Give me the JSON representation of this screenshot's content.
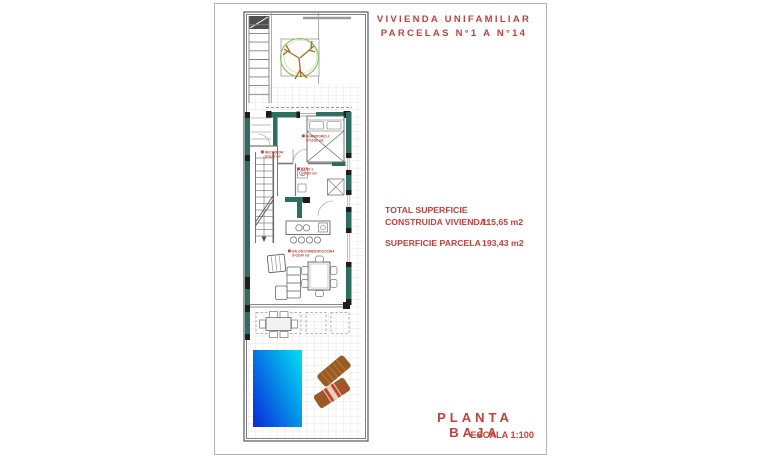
{
  "header": {
    "title_line1": "VIVIENDA UNIFAMILIAR",
    "title_line2": "PARCELAS N°1 A N°14"
  },
  "summary": {
    "total_label_line1": "TOTAL SUPERFICIE",
    "total_label_line2": "CONSTRUIDA VIVIENDA:",
    "total_value": "115,65 m2",
    "parcel_label": "SUPERFICIE PARCELA :",
    "parcel_value": "193,43 m2"
  },
  "footer": {
    "plan_title": "PLANTA BAJA",
    "scale": "ESCALA 1:100"
  },
  "plan_labels": {
    "bedroom_line1": "DORMITORIO 1",
    "bedroom_line2": "S=10,80 m2",
    "hall_line1": "RECIBIDOR",
    "hall_line2": "S=3,40 m2",
    "bath_line1": "BAÑO 1",
    "bath_line2": "S=4,10 m2",
    "living_line1": "SALON-COMEDOR-COCINA",
    "living_line2": "S=28,40 m2"
  },
  "colors": {
    "accent_red": "#c2413b",
    "wall_teal": "#2c6e60",
    "wall_dark": "#1d1d1d",
    "line_gray": "#8c8c8c",
    "grid_gray": "#dcdcdc",
    "tree_green": "#8cbd58",
    "branch_brown": "#a06c2e",
    "pool_deep": "#0a34dc",
    "pool_light": "#00d5f2",
    "lounger_brown": "#9a5a23",
    "lounger_slat": "#b5793a",
    "towel_cream": "#e6d3b4"
  }
}
